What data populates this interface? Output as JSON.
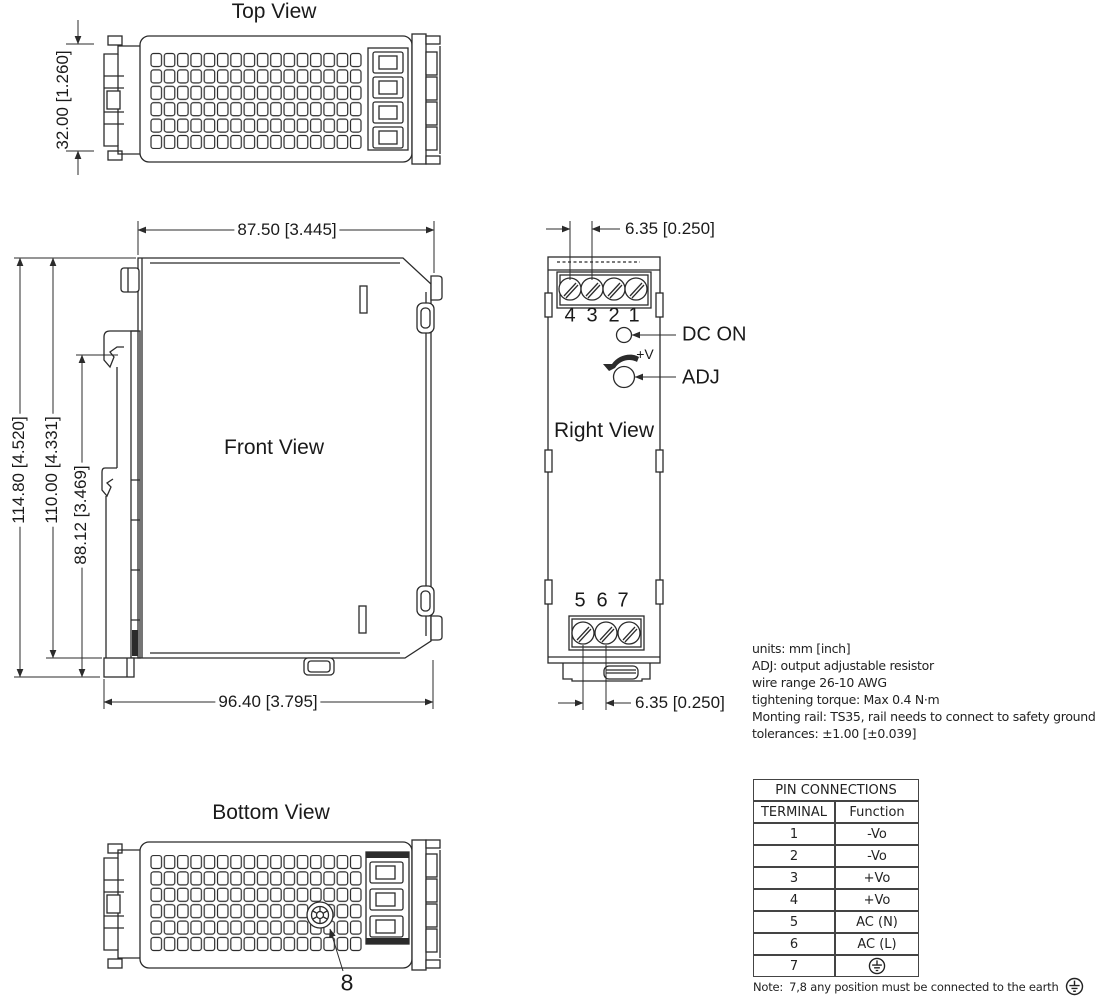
{
  "views": {
    "top": {
      "title": "Top View"
    },
    "front": {
      "title": "Front View"
    },
    "right": {
      "title": "Right View"
    },
    "bottom": {
      "title": "Bottom View"
    }
  },
  "dimensions": {
    "top_clip_height": "32.00 [1.260]",
    "front_width_top": "87.50 [3.445]",
    "front_height_total": "114.80 [4.520]",
    "front_height_body": "110.00 [4.331]",
    "front_height_clip": "88.12 [3.469]",
    "front_width_bottom": "96.40 [3.795]",
    "terminal_pitch_top": "6.35 [0.250]",
    "terminal_pitch_bottom": "6.35 [0.250]"
  },
  "right_view": {
    "top_terminals": [
      "4",
      "3",
      "2",
      "1"
    ],
    "bottom_terminals": [
      "5",
      "6",
      "7"
    ],
    "dc_on_label": "DC ON",
    "adj_label": "ADJ",
    "adj_plus_v": "+V"
  },
  "bottom_view": {
    "ground_screw_label": "8"
  },
  "notes": {
    "lines": [
      "units: mm [inch]",
      "ADJ: output adjustable resistor",
      "wire range 26-10 AWG",
      "tightening torque: Max 0.4 N·m",
      "Monting rail: TS35, rail needs to connect to safety ground",
      "tolerances: ±1.00 [±0.039]"
    ]
  },
  "pin_table": {
    "title": "PIN CONNECTIONS",
    "headers": [
      "TERMINAL",
      "Function"
    ],
    "rows": [
      {
        "terminal": "1",
        "function": "-Vo"
      },
      {
        "terminal": "2",
        "function": "-Vo"
      },
      {
        "terminal": "3",
        "function": "+Vo"
      },
      {
        "terminal": "4",
        "function": "+Vo"
      },
      {
        "terminal": "5",
        "function": "AC (N)"
      },
      {
        "terminal": "6",
        "function": "AC (L)"
      },
      {
        "terminal": "7",
        "function": "earth-ground-symbol"
      }
    ],
    "note_prefix": "Note:",
    "note_text": "7,8 any position must be connected to the earth"
  },
  "colors": {
    "line": "#2b2b2b",
    "text": "#1a1a1a",
    "background": "#ffffff"
  }
}
